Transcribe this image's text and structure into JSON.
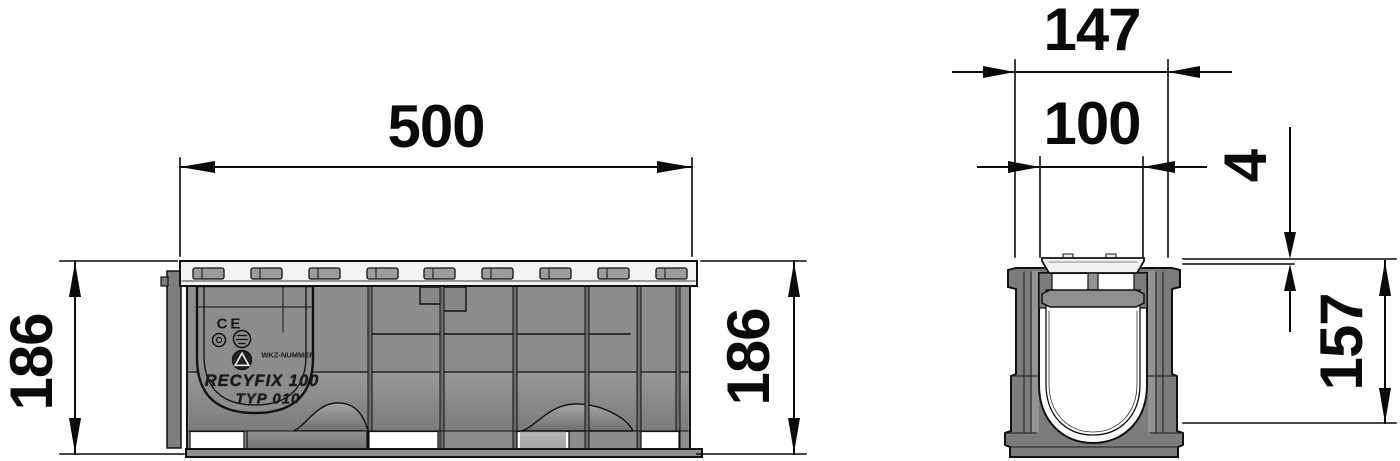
{
  "side_view": {
    "dim_length": "500",
    "dim_height_left": "186",
    "dim_height_right": "186",
    "markings": {
      "ce": "CE",
      "tool_number": "WKZ-NUMMER",
      "product": "RECYFIX 100",
      "type": "TYP 010"
    }
  },
  "section_view": {
    "dim_overall_width": "147",
    "dim_clear_width": "100",
    "dim_edge_offset": "4",
    "dim_depth": "157"
  },
  "colors": {
    "line": "#111111",
    "body_gray": "#8d8d8d",
    "wall_gray": "#7c7c7c",
    "grate_light": "#f3f3f3",
    "slot_gray": "#9c9c9c",
    "background": "#ffffff"
  }
}
